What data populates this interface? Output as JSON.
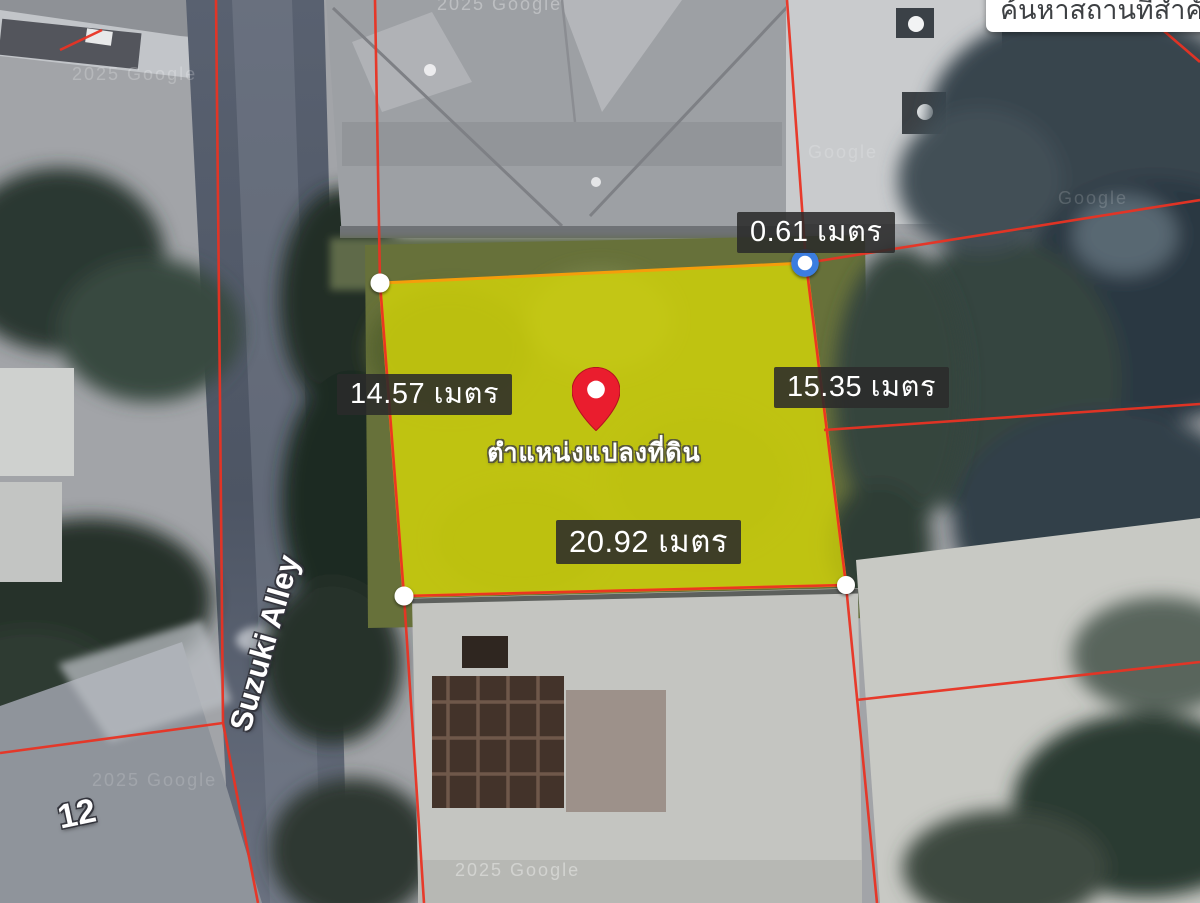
{
  "search_box": {
    "text": "ค้นหาสถานที่สำคัญ"
  },
  "plot": {
    "measurements": {
      "top_offset": "0.61 เมตร",
      "left_side": "14.57 เมตร",
      "right_side": "15.35 เมตร",
      "bottom_side": "20.92 เมตร"
    },
    "pin_label": "ตำแหน่งแปลงที่ดิน"
  },
  "street_labels": {
    "alley_name": "Suzuki Alley",
    "house_number": "12"
  },
  "watermarks": [
    "2025 Google",
    "2025 Google",
    "2025 Google",
    "Google",
    "Google",
    "2025 Google"
  ],
  "colors": {
    "plot_fill": "#d9da07",
    "plot_stroke": "#f59e0b",
    "parcel_line": "#e93323",
    "selected_vertex_ring": "#3b7de0",
    "pin": "#ea1d2e",
    "label_background": "rgba(43,43,43,0.87)"
  }
}
